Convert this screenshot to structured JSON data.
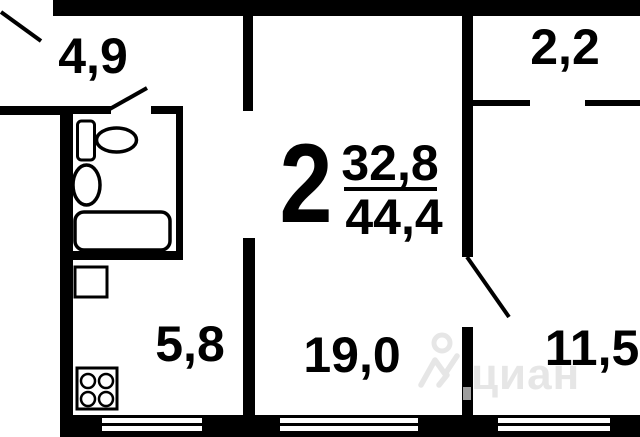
{
  "apartment": {
    "rooms_count": "2",
    "living_area": "32,8",
    "total_area": "44,4"
  },
  "rooms": {
    "hallway": {
      "area": "4,9"
    },
    "storage": {
      "area": "2,2"
    },
    "kitchen": {
      "area": "5,8"
    },
    "living_room": {
      "area": "19,0"
    },
    "bedroom": {
      "area": "11,5"
    }
  },
  "watermark": {
    "text": "циан",
    "logo": "cian-person-house-icon"
  },
  "colors": {
    "walls": "#000000",
    "background": "#ffffff",
    "watermark": "#e6e6e6"
  }
}
